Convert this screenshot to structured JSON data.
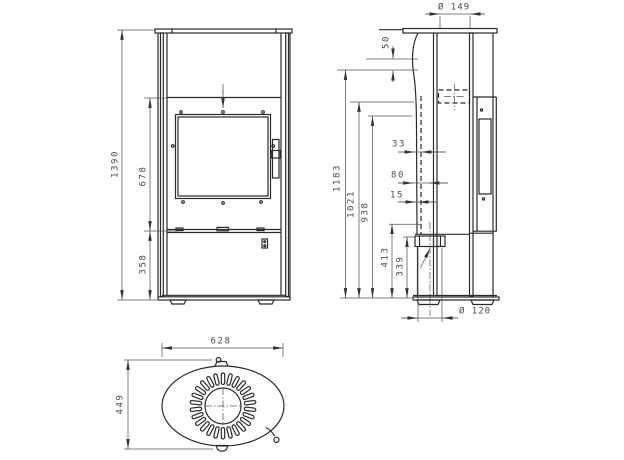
{
  "views": {
    "front": {
      "dims": {
        "overall_height": "1390",
        "mid_section_height": "678",
        "base_height": "358"
      }
    },
    "side": {
      "dims": {
        "flue_diameter": "Ø 149",
        "top_offset": "50",
        "rear_offset": "33",
        "outlet_depth": "80",
        "liner_gap": "15",
        "height_1": "1183",
        "height_2": "1021",
        "height_3": "938",
        "height_4": "413",
        "height_5": "339",
        "air_inlet_diameter": "Ø 120"
      }
    },
    "top": {
      "dims": {
        "overall_width": "628",
        "overall_depth": "449"
      }
    }
  }
}
